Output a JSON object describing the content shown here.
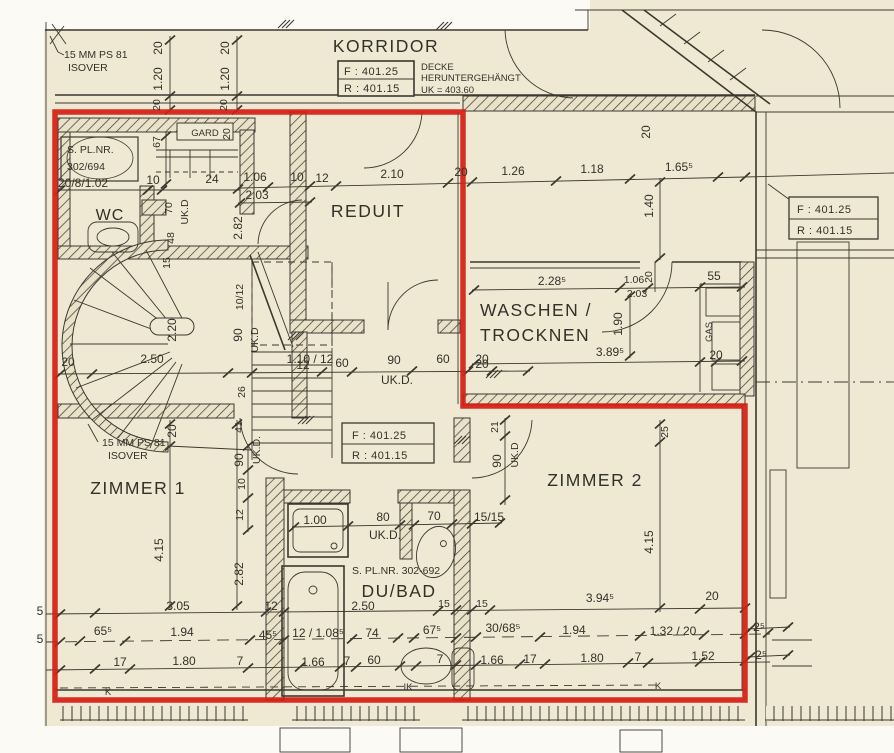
{
  "palette": {
    "paper": "#efe9d3",
    "ink": "#3b382f",
    "red": "#d61d12",
    "white": "#fbfaf4"
  },
  "rooms": {
    "korridor": "KORRIDOR",
    "wc": "WC",
    "reduit": "REDUIT",
    "waschen1": "WASCHEN /",
    "waschen2": "TROCKNEN",
    "zimmer1": "ZIMMER 1",
    "zimmer2": "ZIMMER 2",
    "dubad": "DU/BAD",
    "gard": "GARD"
  },
  "levels": {
    "f": "F : 401.25",
    "r": "R : 401.15"
  },
  "notes": {
    "isover1a": "15 MM PS 81",
    "isover1b": "ISOVER",
    "isover2a": "15 MM PS 81",
    "isover2b": "ISOVER",
    "decke1": "DECKE",
    "decke2": "HERUNTERGEHÄNGT",
    "decke3": "UK = 403.60",
    "plnr_wc_1": "S. PL.NR.",
    "plnr_wc_2": "302/694",
    "plnr_bad": "S. PL.NR. 302-692",
    "door_spec": "20/8/1.02",
    "gas": "GAS"
  },
  "dims": {
    "t20a": "20",
    "t120a": "1.20",
    "t20b": "20",
    "t20c": "20",
    "t120b": "1.20",
    "t20d": "20",
    "tr20": "20",
    "h10a": "10",
    "h24": "24",
    "h106": "1.06",
    "h203": "2.03",
    "h10b": "10",
    "h12": "12",
    "h210": "2.10",
    "h20": "20",
    "h126": "1.26",
    "h118": "1.18",
    "h165": "1.65⁵",
    "v140": "1.40",
    "v67": "67",
    "v20g": "20",
    "v70": "70",
    "vukd1": "UK.D",
    "v48": "48",
    "v282": "2.82",
    "v220": "2.20",
    "h250": "2.50",
    "v1012": "10/12",
    "v90s": "90",
    "vukd2": "UK.D",
    "h11012": "1.10 / 12",
    "h20st": "20",
    "v26": "26",
    "v15": "15",
    "m12": "12",
    "m60a": "60",
    "m90": "90",
    "mukd": "UK.D.",
    "m60b": "60",
    "m20": "20",
    "w2285": "2.28⁵",
    "w106": "1.06",
    "w203": "2.03",
    "w20v": "20",
    "w55": "55",
    "w190": "1.90",
    "w3895": "3.89⁵",
    "w20a": "20",
    "w20b": "20",
    "z21": "21",
    "z90": "90",
    "zukd": "UK.D",
    "z1515": "15/15",
    "z25": "25",
    "z415": "4.15",
    "y20": "20",
    "y41": "41",
    "y90": "90",
    "yukd": "UK.D.",
    "y10": "10",
    "y12": "12",
    "y415": "4.15",
    "y282": "2.82",
    "b100": "1.00",
    "b80": "80",
    "bukd": "UK.D.",
    "b70": "70",
    "b250": "2.50",
    "b15a": "15",
    "b15b": "15",
    "a305": "3.05",
    "a12": "12",
    "a3945": "3.94⁵",
    "a20": "20",
    "bb655": "65⁵",
    "bb194a": "1.94",
    "bb455": "45⁵",
    "bb12108": "12 / 1.08⁵",
    "bb74": "74",
    "bb675": "67⁵",
    "bb30685": "30/68⁵",
    "bb194b": "1.94",
    "bb13220": "1.32 / 20",
    "bb25a": "2⁵",
    "bb25b": "2⁵",
    "c17a": "17",
    "c180a": "1.80",
    "c7a": "7",
    "c166a": "1.66",
    "c7b": "7",
    "c60": "60",
    "c7c": "7",
    "c166b": "1.66",
    "c17b": "17",
    "c180b": "1.80",
    "c7d": "7",
    "c152": "1.52",
    "k1": "K",
    "k2": "IK",
    "k3": "K",
    "e5a": "5",
    "e5b": "5"
  }
}
